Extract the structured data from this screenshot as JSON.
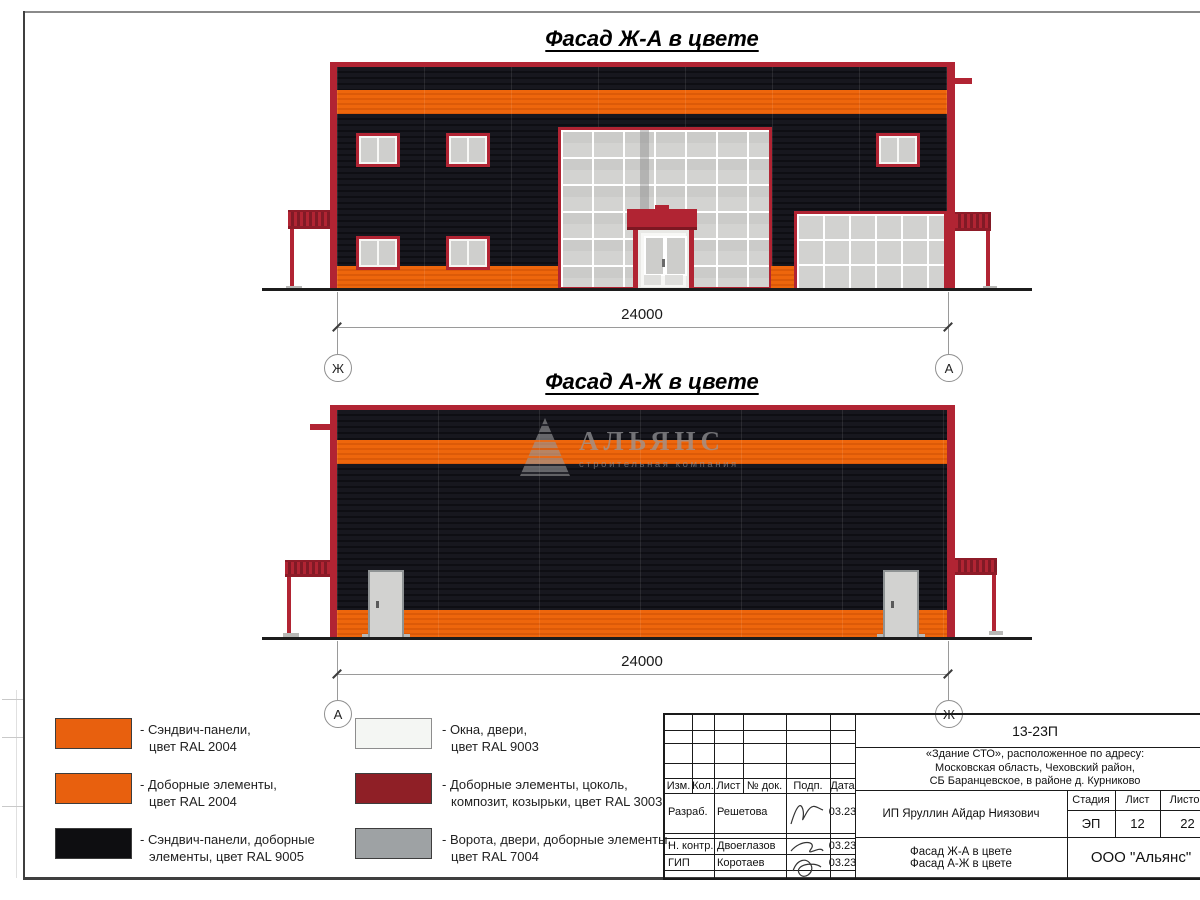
{
  "drawing": {
    "facade_top": {
      "title": "Фасад Ж-А в цвете",
      "dimension": "24000",
      "axis_left": "Ж",
      "axis_right": "А"
    },
    "facade_bottom": {
      "title": "Фасад А-Ж в цвете",
      "dimension": "24000",
      "axis_left": "А",
      "axis_right": "Ж"
    },
    "watermark": {
      "name": "АЛЬЯНС",
      "subtitle": "строительная компания"
    }
  },
  "legend": {
    "items": [
      {
        "color": "#E8600E",
        "line1": "- Сэндвич-панели,",
        "line2": "цвет RAL 2004"
      },
      {
        "color": "#E8600E",
        "line1": "- Доборные элементы,",
        "line2": "цвет RAL 2004"
      },
      {
        "color": "#0E0E11",
        "line1": "- Сэндвич-панели, доборные",
        "line2": "элементы, цвет RAL 9005"
      },
      {
        "color": "#F4F6F3",
        "line1": "- Окна, двери,",
        "line2": "цвет RAL 9003"
      },
      {
        "color": "#8F1F26",
        "line1": "- Доборные элементы, цоколь,",
        "line2": "композит, козырьки, цвет RAL 3003"
      },
      {
        "color": "#9EA2A4",
        "line1": "- Ворота, двери, доборные элементы,",
        "line2": "цвет RAL 7004"
      }
    ]
  },
  "titleblock": {
    "doc_number": "13-23П",
    "project_line1": "«Здание СТО», расположенное по адресу:",
    "project_line2": "Московская область, Чеховский район,",
    "project_line3": "СБ Баранцевское, в районе д. Курниково",
    "client": "ИП Яруллин Айдар Ниязович",
    "columns": {
      "izm": "Изм.",
      "kol": "Кол.",
      "list": "Лист",
      "ndok": "№ док.",
      "podp": "Подп.",
      "data": "Дата"
    },
    "stage_label": "Стадия",
    "sheet_label": "Лист",
    "sheets_label": "Листов",
    "stage_value": "ЭП",
    "sheet_value": "12",
    "sheets_value": "22",
    "rows": [
      {
        "role": "Разраб.",
        "name": "Решетова",
        "date": "03.23"
      },
      {
        "role": "Н. контр.",
        "name": "Двоеглазов",
        "date": "03.23"
      },
      {
        "role": "ГИП",
        "name": "Коротаев",
        "date": "03.23"
      }
    ],
    "drawing_title_line1": "Фасад Ж-А в цвете",
    "drawing_title_line2": "Фасад А-Ж в цвете",
    "company": "ООО \"Альянс\""
  }
}
